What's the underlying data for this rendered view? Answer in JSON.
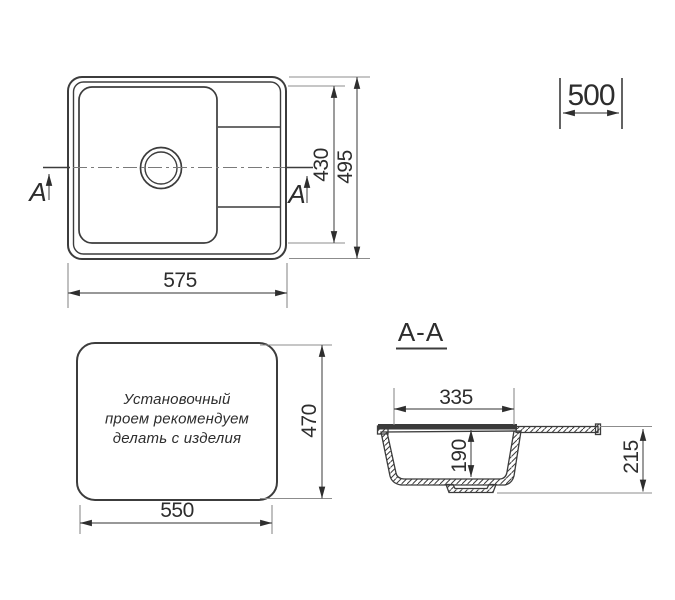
{
  "colors": {
    "background": "#ffffff",
    "line": "#3c3c3c",
    "dim_line": "#5a5a5a",
    "extension_line": "#8c8c8c",
    "text": "#2d2d2d"
  },
  "plan_view": {
    "dims": {
      "overall_width": "575",
      "inner_depth": "430",
      "overall_depth": "495"
    },
    "section_label_left": "A",
    "section_label_right": "A"
  },
  "cabinet_width": {
    "value": "500"
  },
  "cutout_view": {
    "note": [
      "Установочный",
      "проем рекомендуем",
      "делать с изделия"
    ],
    "dims": {
      "width": "550",
      "depth": "470"
    }
  },
  "section_view": {
    "title": "A-A",
    "dims": {
      "bowl_width": "335",
      "bowl_depth": "190",
      "overall_height": "215"
    }
  }
}
